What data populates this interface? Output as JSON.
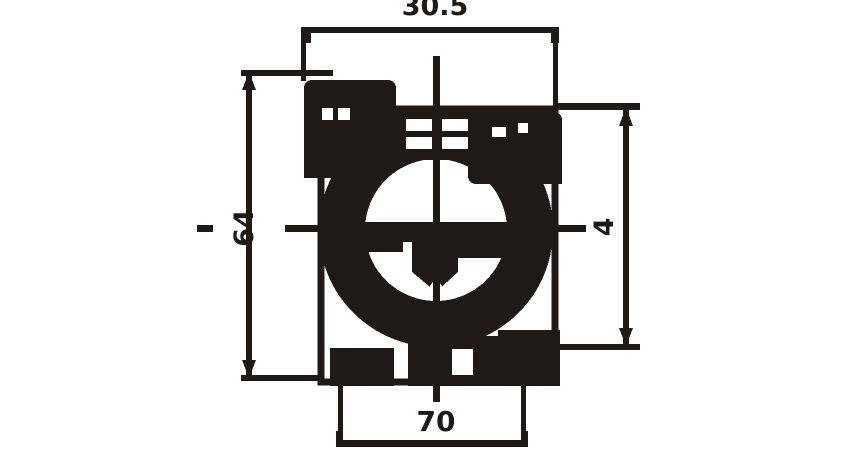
{
  "drawing": {
    "dimension_labels": {
      "top": "30.5",
      "left": "64",
      "right": "4",
      "bottom": "70"
    },
    "colors": {
      "ink": "#201a16",
      "background": "#ffffff"
    }
  }
}
